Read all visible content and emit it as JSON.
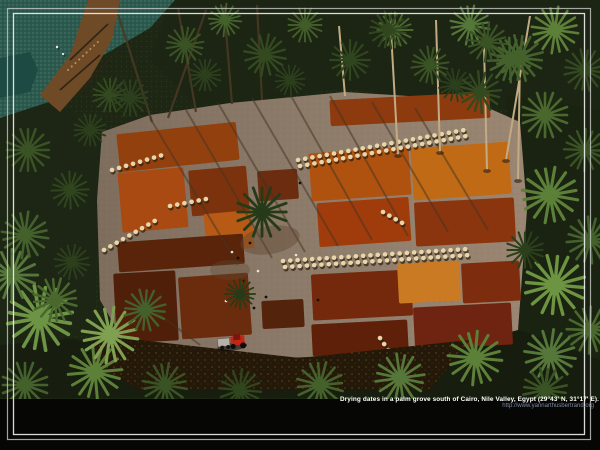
{
  "photo": {
    "description": "Aerial photograph of dates drying in red, orange and brown patches on a cleared field inside a palm grove, with palm trees, a canal-side teal crop field, workers and a red tractor",
    "caption": {
      "line1": "Drying dates in a palm grove south of Cairo, Nile Valley, Egypt (29°43' N, 31°17' E).",
      "line2": "http://www.yannarthusbertrand.org"
    },
    "colors": {
      "caption_text": "#ffffff",
      "credit_url_text": "#7e89a2",
      "frame_line": "#f2f2f2",
      "background": "#000000",
      "canopy_green": "#1e2614",
      "clearing_soil": "#8f7d6c",
      "date_patch_red": "#a03c0c",
      "date_patch_orange": "#c06a16",
      "date_patch_maroon": "#5e2009",
      "teal_field": "#2d5a4e",
      "tractor_red": "#c32614"
    }
  }
}
